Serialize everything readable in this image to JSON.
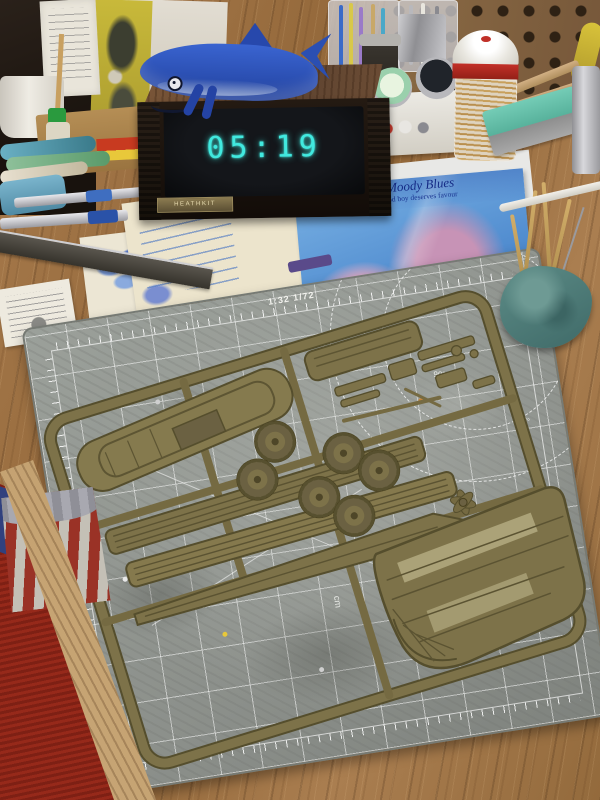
{
  "meta": {
    "description": "Photograph of a hobby workbench: an olive-drab model kit sprue lying on a grey cutting mat, a wood-cased Heathkit LED clock with a blue plush shark on top, hobby tools, papers, an album cover and containers on a wood desk, red carpet visible under the desk edge."
  },
  "clock": {
    "time": "05:19",
    "brand": "HEATHKIT",
    "digit_color": "#41e9df",
    "case_color": "#5d4330"
  },
  "shark": {
    "body_color": "#2b4fb2"
  },
  "cutting_mat": {
    "scale_label": "1:32 1/72",
    "angle_labels": [
      "90°",
      "72°"
    ],
    "unit_label": "cm",
    "mat_color": "#949893",
    "grid_color": "#ffffff"
  },
  "sprue": {
    "plastic_color": "#7d7249",
    "wheel_count": 6,
    "parts": [
      "upper-hull-deck",
      "cargo-deck",
      "hull-strips",
      "road-wheels",
      "small-parts",
      "propeller",
      "lower-hull"
    ]
  },
  "album_cover": {
    "artist": "The Moody Blues",
    "title": "every good boy deserves favour",
    "base_color": "#5b97d8"
  },
  "poem_card": {
    "title": "WING OF LOVE"
  },
  "floor": {
    "carpet_color": "#8a2418"
  }
}
